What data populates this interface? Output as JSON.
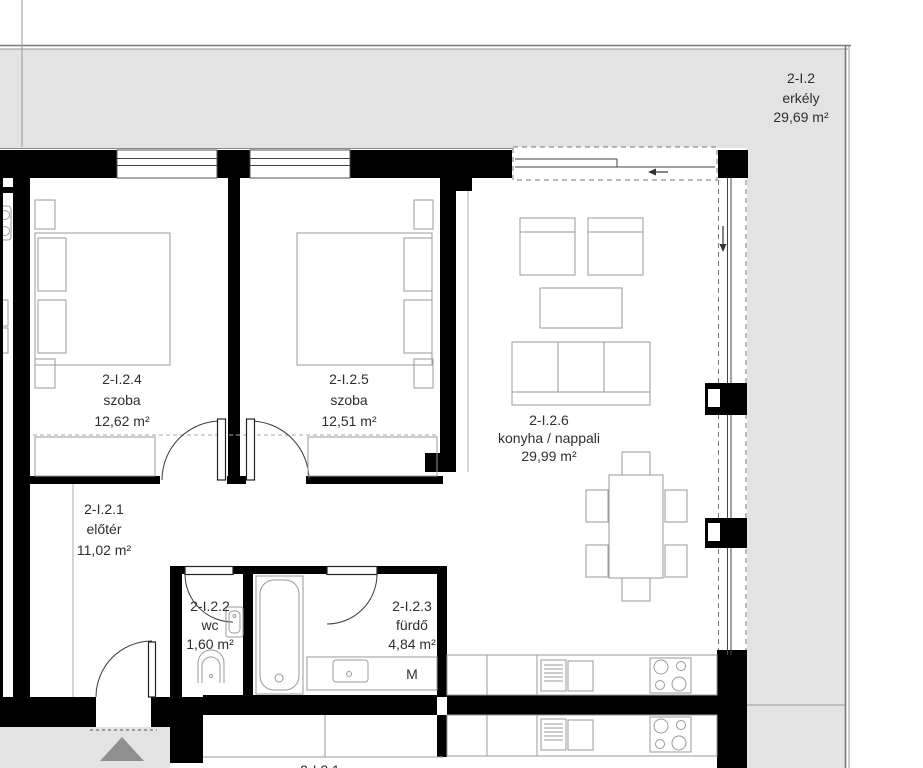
{
  "balcony": {
    "id": "2-I.2",
    "name": "erkély",
    "area": "29,69 m²"
  },
  "rooms": {
    "hall": {
      "id": "2-I.2.1",
      "name": "előtér",
      "area": "11,02 m²"
    },
    "wc": {
      "id": "2-I.2.2",
      "name": "wc",
      "area": "1,60 m²"
    },
    "bath": {
      "id": "2-I.2.3",
      "name": "fürdő",
      "area": "4,84 m²"
    },
    "bedroom1": {
      "id": "2-I.2.4",
      "name": "szoba",
      "area": "12,62 m²"
    },
    "bedroom2": {
      "id": "2-I.2.5",
      "name": "szoba",
      "area": "12,51 m²"
    },
    "living": {
      "id": "2-I.2.6",
      "name": "konyha / nappali",
      "area": "29,99 m²"
    }
  },
  "annotations": {
    "washing_machine": "M",
    "adjacent_unit_label": "2-I.2.1"
  },
  "icons": {
    "slide_left_arrow": "←",
    "slide_down_arrow": "↓",
    "entry_direction_triangle": "▲"
  },
  "colors": {
    "wall": "#000000",
    "balcony_fill": "#e3e3e3",
    "corridor_fill": "#e3e3e3",
    "furniture_line": "#9a9a9a",
    "text": "#2f2f2f",
    "entry_triangle": "#8f8f8f"
  }
}
